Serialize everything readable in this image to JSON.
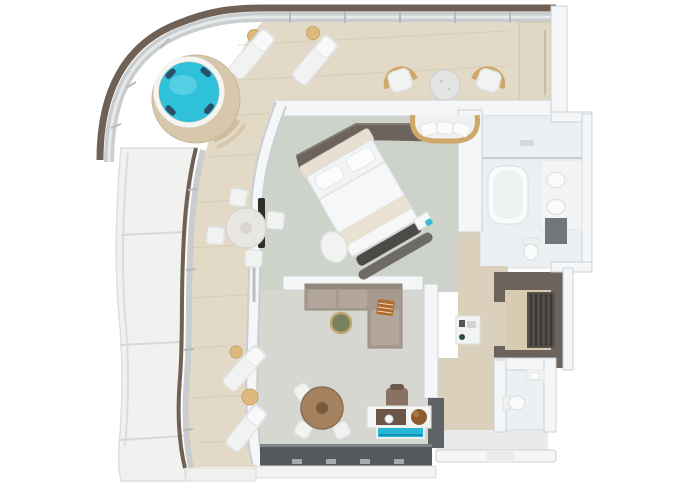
{
  "scene": {
    "type": "3d-floorplan-top-down-render",
    "subject": "ship suite with wrap-around curved balcony",
    "background": "#ffffff"
  },
  "colors": {
    "hull_band": "#6f6156",
    "railing": "#c9cdcf",
    "railing_glass": "#e6e9ea",
    "deck_wood": "#e3d9c7",
    "deck_plank_line": "#d2c4ab",
    "hull_structure": "#f1f2f0",
    "privacy_panel": "#e0d6c4",
    "hot_tub_platform": "#d6c7ad",
    "hot_tub_water": "#2fc0da",
    "hot_tub_jets": "#27506a",
    "bedroom_carpet": "#cdd2cb",
    "bedroom_border": "#dcd3bf",
    "living_carpet": "#d7d7d2",
    "corridor_carpet": "#dbd0bb",
    "bathroom_floor": "#edf0f2",
    "closet_cabinetry": "#6b635c",
    "closet_floor": "#d8cbb2",
    "closet_rail_dark": "#3b3836",
    "wardrobe_band": "#6b635c",
    "sofa": "#a69a8f",
    "sofa_cushion": "#b3a79c",
    "throw_blanket": "#b06a2c",
    "coffee_table": "#77805f",
    "dining_table_wood": "#a5825f",
    "desk_wood": "#6b5546",
    "desk_chair": "#8a7262",
    "globe": "#8a5c30",
    "aquarium": "#29b7d8",
    "window_band": "#54595d",
    "rattan_trim": "#cfa768",
    "bed_linen": "#f3f4f5",
    "headboard": "#e7e0d2",
    "bench_dark": "#4c4a47",
    "tv_panel": "#2f2e2d",
    "dark_cabinet": "#5f6366",
    "shower_partition": "#72767a",
    "minibar_bottle": "#2e4f33"
  },
  "rooms": [
    {
      "id": "balcony-deck"
    },
    {
      "id": "bedroom"
    },
    {
      "id": "master-bathroom"
    },
    {
      "id": "walk-in-closet"
    },
    {
      "id": "hallway"
    },
    {
      "id": "living-room"
    },
    {
      "id": "guest-bathroom"
    },
    {
      "id": "entry"
    }
  ],
  "furniture": [
    {
      "id": "hot-tub",
      "room": "balcony-deck"
    },
    {
      "id": "sun-lounger",
      "room": "balcony-deck",
      "count": 4
    },
    {
      "id": "side-table",
      "room": "balcony-deck",
      "count": 4
    },
    {
      "id": "outdoor-armchair",
      "room": "balcony-deck",
      "count": 2
    },
    {
      "id": "outdoor-round-table",
      "room": "balcony-deck"
    },
    {
      "id": "outdoor-sofa",
      "room": "balcony-deck"
    },
    {
      "id": "outdoor-dining-table",
      "room": "balcony-deck"
    },
    {
      "id": "outdoor-dining-chair",
      "room": "balcony-deck",
      "count": 4
    },
    {
      "id": "king-bed",
      "room": "bedroom"
    },
    {
      "id": "foot-bench",
      "room": "bedroom"
    },
    {
      "id": "ottoman",
      "room": "bedroom"
    },
    {
      "id": "tv-panel",
      "room": "bedroom"
    },
    {
      "id": "wardrobe-cabinets",
      "room": "bedroom"
    },
    {
      "id": "bathtub",
      "room": "master-bathroom"
    },
    {
      "id": "twin-sinks",
      "room": "master-bathroom"
    },
    {
      "id": "shower",
      "room": "master-bathroom"
    },
    {
      "id": "toilet",
      "room": "master-bathroom"
    },
    {
      "id": "hanging-rails",
      "room": "walk-in-closet"
    },
    {
      "id": "minibar-niche",
      "room": "hallway"
    },
    {
      "id": "sectional-sofa",
      "room": "living-room"
    },
    {
      "id": "throw-blanket",
      "room": "living-room"
    },
    {
      "id": "coffee-table",
      "room": "living-room"
    },
    {
      "id": "dining-table",
      "room": "living-room"
    },
    {
      "id": "dining-chair",
      "room": "living-room",
      "count": 3
    },
    {
      "id": "desk-chair",
      "room": "living-room"
    },
    {
      "id": "console",
      "room": "living-room"
    },
    {
      "id": "globe",
      "room": "living-room"
    },
    {
      "id": "aquarium",
      "room": "living-room"
    },
    {
      "id": "window-wall",
      "room": "living-room"
    },
    {
      "id": "toilet",
      "room": "guest-bathroom"
    },
    {
      "id": "wall-sink",
      "room": "guest-bathroom"
    }
  ]
}
